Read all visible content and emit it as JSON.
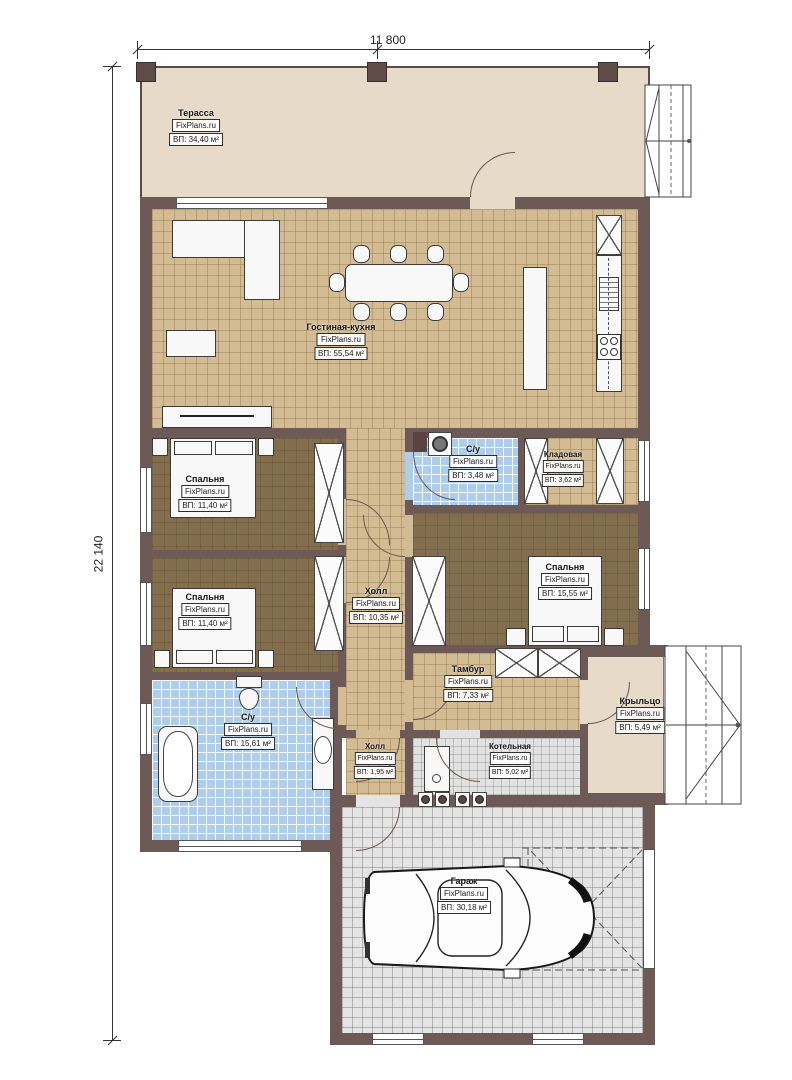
{
  "brand": "FixPlans.ru",
  "dimensions": {
    "width_mm": "11 800",
    "height_mm": "22 140"
  },
  "rooms": {
    "terrace": {
      "name": "Терасса",
      "area": "ВП: 34,40 м²"
    },
    "living": {
      "name": "Гостиная-кухня",
      "area": "ВП: 55,54 м²"
    },
    "bedroom1": {
      "name": "Спальня",
      "area": "ВП: 11,40 м²"
    },
    "bathroom_small": {
      "name": "С/у",
      "area": "ВП: 3,48 м²"
    },
    "storage": {
      "name": "Кладовая",
      "area": "ВП: 3,62 м²"
    },
    "bedroom2": {
      "name": "Спальня",
      "area": "ВП: 11,40 м²"
    },
    "hall": {
      "name": "Холл",
      "area": "ВП: 10,35 м²"
    },
    "bedroom3": {
      "name": "Спальня",
      "area": "ВП: 15,55 м²"
    },
    "tambour": {
      "name": "Тамбур",
      "area": "ВП: 7,33 м²"
    },
    "porch": {
      "name": "Крыльцо",
      "area": "ВП: 5,49 м²"
    },
    "bathroom_big": {
      "name": "С/у",
      "area": "ВП: 15,61 м²"
    },
    "hall_small": {
      "name": "Холл",
      "area": "ВП: 1,95 м²"
    },
    "boiler": {
      "name": "Котельная",
      "area": "ВП: 5,02 м²"
    },
    "garage": {
      "name": "Гараж",
      "area": "ВП: 30,18 м²"
    }
  },
  "colors": {
    "wall": "#6d5a57",
    "floor_tan": "#d3bc93",
    "floor_brown": "#826e4d",
    "floor_blue": "#aecdea",
    "floor_gray": "#e2e2e2",
    "floor_beige": "#e7dac8"
  }
}
